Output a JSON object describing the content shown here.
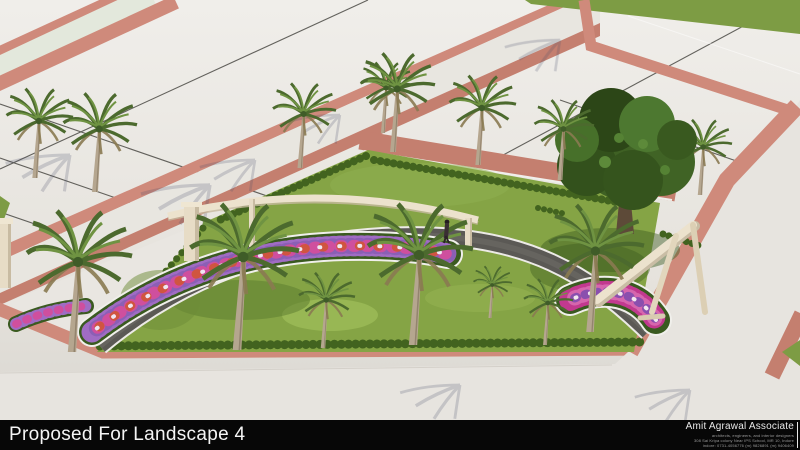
{
  "footer": {
    "caption": "Proposed For Landscape 4",
    "firm_name": "Amit Agrawal Associate",
    "firm_tagline": "architects, engineers, and interior designers",
    "firm_address": "308 Sai Kripa colony Near IPS School, MR 10, Indore",
    "firm_contact": "indore: 0731-4056776 (m) 9826891 (m) 9406409"
  },
  "scene": {
    "subject": "3D render of proposed landscape garden with palm trees, curved pergola, flower beds and paver roads",
    "colors": {
      "pavement": "#e7e4df",
      "road_surface": "#e3e8dc",
      "paver": "#cf8a7b",
      "paver_dark": "#c47f6f",
      "grass": "#85a445",
      "grass_dark": "#5e7c30",
      "hedge": "#42631f",
      "path": "#5b5955",
      "curb": "#eceae6",
      "structure": "#ece2cd",
      "tree_foliage": "#3f6124",
      "palm_frond": "#4c6a2e",
      "flower_purple": "#a06cc4",
      "flower_magenta": "#cf4f9e",
      "flower_red": "#d05540",
      "bar_background": "#070707",
      "caption_color": "#f4f4f4"
    }
  }
}
